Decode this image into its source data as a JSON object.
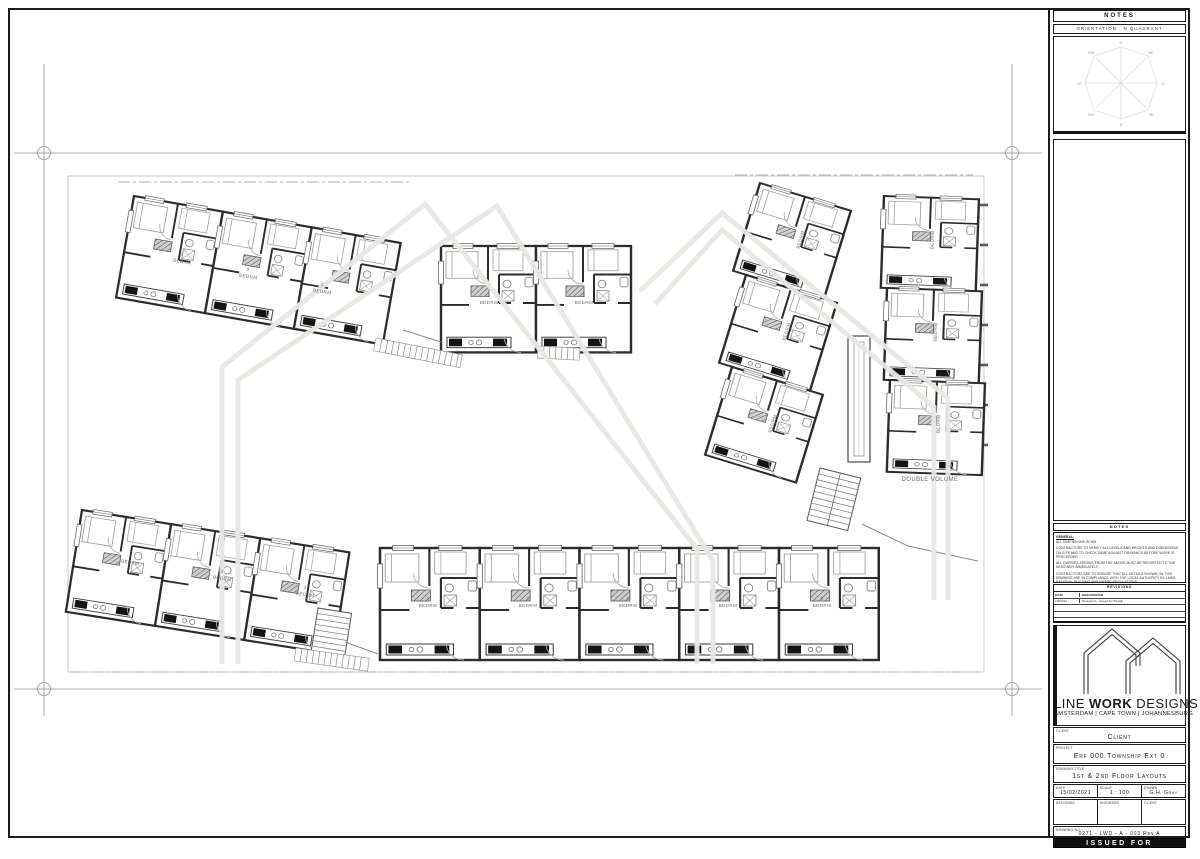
{
  "orientation_panel": {
    "notes_header": "NOTES",
    "orientation_label": "ORIENTATION : N QUADRANT",
    "compass": [
      "N",
      "NE",
      "E",
      "SE",
      "S",
      "SW",
      "W",
      "NW"
    ]
  },
  "notes_panel": {
    "header": "NOTES",
    "general_label": "GENERAL:",
    "items": [
      "ALL DIMENSIONS IN MM.",
      "CONTRACTORS TO VERIFY ALL LEVELS AND HEIGHTS AND DIMENSIONS ON SITE AND TO CHECK SAME AGAINST DRAWINGS BEFORE WORK IS PROCEEDED.",
      "ALL QUERIES ARISING FROM THE ABOVE MUST BE REPORTED TO THE DESIGNER IMMEDIATELY.",
      "CONTRACTORS ARE TO ENSURE THAT ALL DETAILS SHOWN ON THIS DRAWING ARE IN COMPLIANCE WITH THE LOCAL AUTHORITY BY-LAWS, NATIONAL BUILDING AND NHBRC REGULATIONS.",
      "QUALITY OF WORKMANSHIP AND MATERIALS TO COMPLY WITH SPECIFICATIONS AND SHALL CONFORM TO MINIMUM STANDARDS SPECIFIED BY THE DESIGNER AND ENGINEER."
    ]
  },
  "revisions": {
    "header": "REVISIONS",
    "columns": [
      "DATE",
      "DESCRIPTION"
    ],
    "rows": [
      {
        "date": "15/02/21",
        "description": "Revision A - Issued for Design"
      }
    ]
  },
  "brand": {
    "name_part1": "LINE ",
    "name_part2": "WORK",
    "name_part3": " DESIGNS",
    "cities": "AMSTERDAM | CAPE TOWN | JOHANNESBURG"
  },
  "fields": {
    "client_label": "CLIENT",
    "client_value": "Client",
    "project_label": "PROJECT",
    "project_value": "Erf 000 Township Ext 0",
    "title_label": "DRAWING TITLE",
    "title_value": "1st & 2nd Floor Layouts",
    "date_label": "DATE",
    "date_value": "15/02/2021",
    "scale_label": "SCALE",
    "scale_value": "1 : 100",
    "drawn_label": "DRAWN",
    "drawn_value": "G.H. Gray",
    "designed_label": "DESIGNED",
    "engineer_label": "ENGINEER",
    "client2_label": "CLIENT",
    "drawing_no_label": "DRAWING NO.",
    "drawing_no_value": "0271 - LWD - A - 003 Rev A",
    "status": "ISSUED FOR INFORMATION"
  },
  "plan": {
    "labels": [
      {
        "t": "1",
        "x": 182,
        "y": 256,
        "r": 10
      },
      {
        "t": "BEDRM",
        "x": 182,
        "y": 263,
        "r": 10
      },
      {
        "t": "2",
        "x": 248,
        "y": 271,
        "r": 10
      },
      {
        "t": "BEDRM",
        "x": 248,
        "y": 278,
        "r": 10
      },
      {
        "t": "3",
        "x": 322,
        "y": 286,
        "r": 10
      },
      {
        "t": "BEDRM",
        "x": 322,
        "y": 293,
        "r": 10
      },
      {
        "t": "1",
        "x": 489,
        "y": 297,
        "r": 0
      },
      {
        "t": "BEDRM",
        "x": 489,
        "y": 304,
        "r": 0
      },
      {
        "t": "2",
        "x": 584,
        "y": 297,
        "r": 0
      },
      {
        "t": "BEDRM",
        "x": 584,
        "y": 304,
        "r": 0
      },
      {
        "t": "BEDRM",
        "x": 802,
        "y": 240,
        "r": -73
      },
      {
        "t": "BEDRM",
        "x": 788,
        "y": 332,
        "r": -73
      },
      {
        "t": "BEDRM",
        "x": 774,
        "y": 424,
        "r": -73
      },
      {
        "t": "BEDRM",
        "x": 934,
        "y": 240,
        "r": -88
      },
      {
        "t": "BEDRM",
        "x": 937,
        "y": 332,
        "r": -88
      },
      {
        "t": "BEDRM",
        "x": 940,
        "y": 424,
        "r": -88
      },
      {
        "t": "1",
        "x": 130,
        "y": 557,
        "r": 9
      },
      {
        "t": "BEDRM",
        "x": 130,
        "y": 564,
        "r": 9
      },
      {
        "t": "2",
        "x": 222,
        "y": 573,
        "r": 9
      },
      {
        "t": "BEDRM",
        "x": 222,
        "y": 580,
        "r": 9
      },
      {
        "t": "3",
        "x": 305,
        "y": 589,
        "r": 9
      },
      {
        "t": "BEDRM",
        "x": 305,
        "y": 596,
        "r": 9
      },
      {
        "t": "1",
        "x": 428,
        "y": 600,
        "r": 0
      },
      {
        "t": "BEDRM",
        "x": 428,
        "y": 607,
        "r": 0
      },
      {
        "t": "2",
        "x": 528,
        "y": 600,
        "r": 0
      },
      {
        "t": "BEDRM",
        "x": 528,
        "y": 607,
        "r": 0
      },
      {
        "t": "3",
        "x": 628,
        "y": 600,
        "r": 0
      },
      {
        "t": "BEDRM",
        "x": 628,
        "y": 607,
        "r": 0
      },
      {
        "t": "4",
        "x": 728,
        "y": 600,
        "r": 0
      },
      {
        "t": "BEDRM",
        "x": 728,
        "y": 607,
        "r": 0
      },
      {
        "t": "5",
        "x": 822,
        "y": 600,
        "r": 0
      },
      {
        "t": "BEDRM",
        "x": 822,
        "y": 607,
        "r": 0
      },
      {
        "t": "DOUBLE VOLUME",
        "x": 930,
        "y": 481,
        "r": 0,
        "s": 6
      }
    ]
  }
}
